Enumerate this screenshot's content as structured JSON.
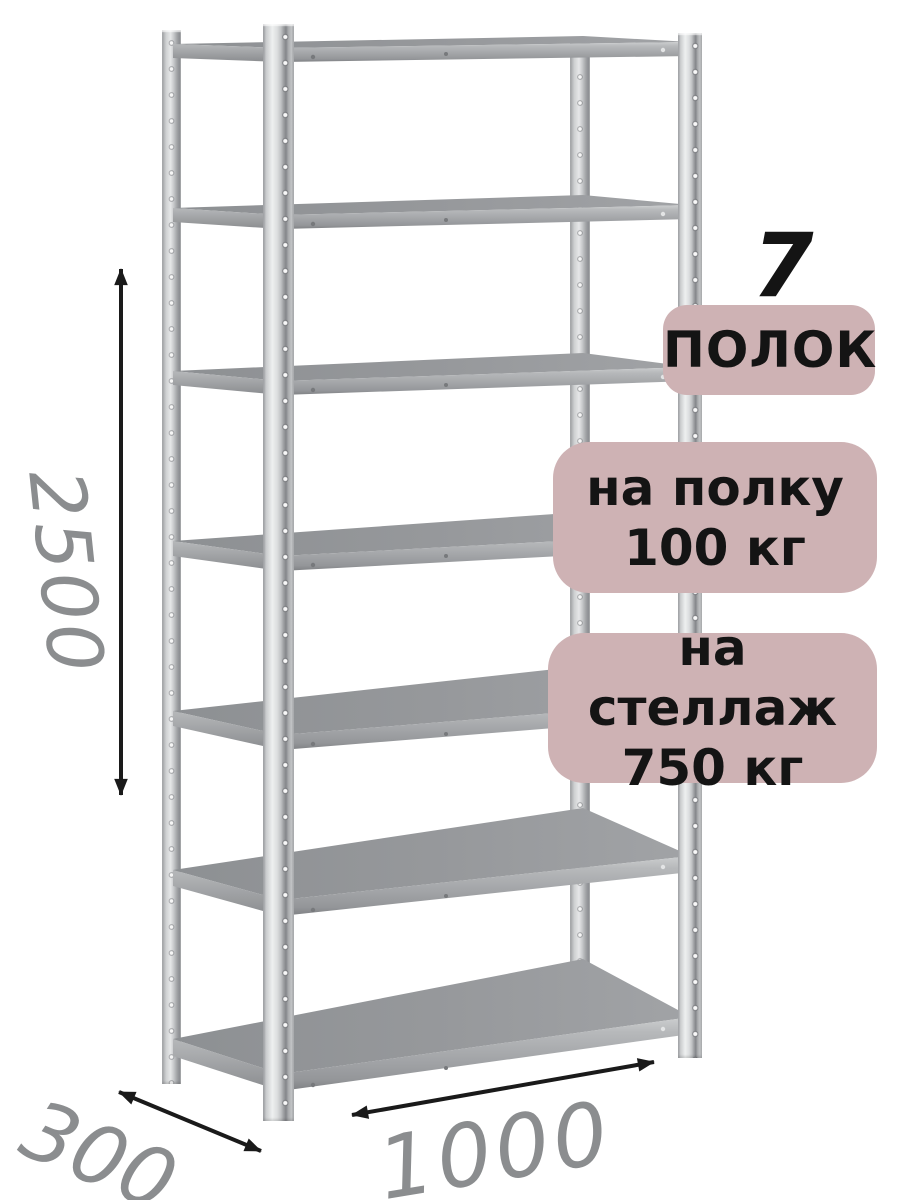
{
  "badges": {
    "count_number": "7",
    "count_label": "ПОЛОК",
    "shelf_load_line1": "на полку",
    "shelf_load_line2": "100 кг",
    "rack_load_line1": "на стеллаж",
    "rack_load_line2": "750 кг"
  },
  "dimensions": {
    "height_mm": "2500",
    "depth_mm": "300",
    "width_mm": "1000"
  },
  "rack": {
    "shelf_count": 7,
    "post_count": 4
  },
  "colors": {
    "badge_bg": "#ceb2b4",
    "badge_text": "#141414",
    "dim_text": "#8b8d8f",
    "arrow": "#1a1a1a"
  }
}
